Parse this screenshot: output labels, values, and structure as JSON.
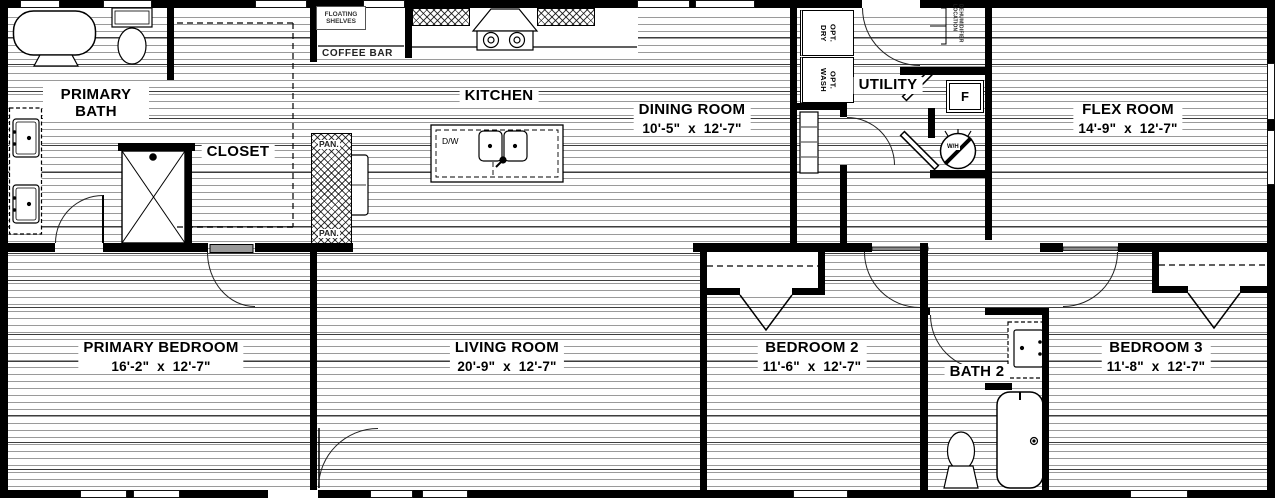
{
  "colors": {
    "wall": "#000000",
    "floor_line": "#9a9a9a",
    "background": "#ffffff"
  },
  "rooms": {
    "primary_bath": {
      "name": "PRIMARY BATH"
    },
    "closet": {
      "name": "CLOSET"
    },
    "kitchen": {
      "name": "KITCHEN"
    },
    "dining_room": {
      "name": "DINING ROOM",
      "dims": "10'-5\" x 12'-7\""
    },
    "utility": {
      "name": "UTILITY"
    },
    "flex_room": {
      "name": "FLEX ROOM",
      "dims": "14'-9\" x 12'-7\""
    },
    "primary_bedroom": {
      "name": "PRIMARY BEDROOM",
      "dims": "16'-2\" x 12'-7\""
    },
    "living_room": {
      "name": "LIVING ROOM",
      "dims": "20'-9\" x 12'-7\""
    },
    "bedroom_2": {
      "name": "BEDROOM 2",
      "dims": "11'-6\" x 12'-7\""
    },
    "bath_2": {
      "name": "BATH 2"
    },
    "bedroom_3": {
      "name": "BEDROOM 3",
      "dims": "11'-8\" x 12'-7\""
    }
  },
  "labels": {
    "floating_shelves": "FLOATING SHELVES",
    "coffee_bar": "COFFEE BAR",
    "pantry_upper": "PAN.",
    "pantry_lower": "PAN.",
    "dishwasher": "D/W",
    "opt_dryer": "OPT. DRY",
    "opt_washer": "OPT. WASH",
    "furnace": "F",
    "water_heater": "W/H",
    "dehumidifier_note": "DEHUMIDIFIER LOCATION"
  }
}
